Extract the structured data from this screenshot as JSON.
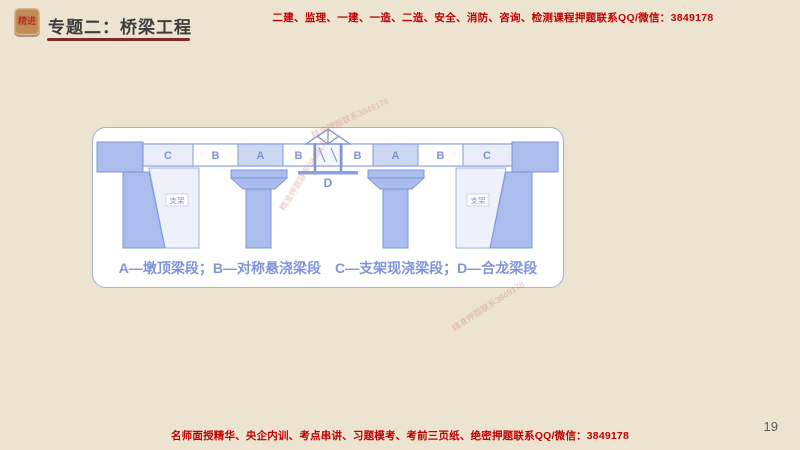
{
  "page": {
    "page_number": "19",
    "background_color": "#ece4d1"
  },
  "header": {
    "logo_text": "精进",
    "title": "专题二：桥梁工程",
    "promo_text": "二建、监理、一建、一造、二造、安全、消防、咨询、检测课程押题联系QQ/微信：3849178"
  },
  "footer": {
    "promo_text": "名师面授精华、央企内训、考点串讲、习题模考、考前三页纸、绝密押题联系QQ/微信：3849178"
  },
  "diagram": {
    "segments": [
      "C",
      "B",
      "A",
      "B",
      "B",
      "A",
      "B",
      "C"
    ],
    "closure_label": "D",
    "support_label_left": "支架",
    "support_label_right": "支架",
    "legend": "A—墩顶梁段；B—对称悬浇梁段　C—支架现浇梁段；D—合龙梁段"
  },
  "watermark": {
    "text": "精准押题联系3849178"
  },
  "colors": {
    "promo_red": "#c00000",
    "title_gray": "#3d3d3d",
    "underline_maroon": "#7e2b26",
    "logo_tan": "#bf8c55",
    "bridge_blue_fill": "#aabdec",
    "bridge_blue_stroke": "#8098d8",
    "segment_a_fill": "#ccd7f1",
    "segment_c_fill": "#e9edf8",
    "legend_blue": "#8094da"
  }
}
